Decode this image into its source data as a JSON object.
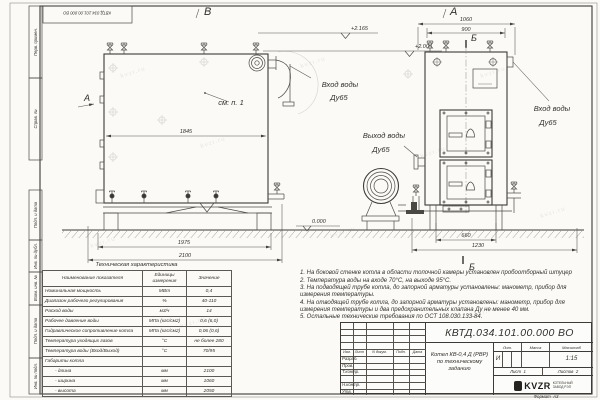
{
  "frame": {
    "doc_number": "КВТД.034.101.00.000 ВО",
    "format_label": "Формат",
    "format_value": "А3",
    "side_labels": [
      "Перв. примен.",
      "Справ. №",
      "Подп. и дата",
      "Инв. № дубл.",
      "Взам. инв. №",
      "Подп. и дата",
      "Инв. № подл."
    ]
  },
  "views": {
    "view_b_label": "В",
    "view_a_label": "А",
    "section_label": "Б",
    "see_note": "см. п. 1",
    "dims": {
      "left_inner": "1845",
      "left_mid": "1975",
      "left_outer": "2100",
      "right_outer": "1060",
      "right_inner": "900",
      "right_base": "660",
      "right_total": "1230"
    },
    "elevations": {
      "top": "+2.165",
      "mid": "+2.000",
      "ground": "0.000"
    },
    "water": {
      "inlet": "Вход воды",
      "outlet": "Выход воды",
      "dy": "Ду65"
    }
  },
  "tech_table": {
    "title": "Техническая характеристика",
    "headers": {
      "name": "Наименование показателя",
      "unit": "Единицы измерения",
      "value": "Значение"
    },
    "rows": [
      {
        "name": "Номинальная мощность",
        "unit": "МВт",
        "value": "0,4"
      },
      {
        "name": "Диапазон рабочего регулирования",
        "unit": "%",
        "value": "40-110"
      },
      {
        "name": "Расход воды",
        "unit": "м3/ч",
        "value": "14"
      },
      {
        "name": "Рабочее давление воды",
        "unit": "МПа (кгс/см2)",
        "value": "0,6 (6,0)"
      },
      {
        "name": "Гидравлическое сопротивление котла",
        "unit": "МПа (кгс/см2)",
        "value": "0,06 (0,6)"
      },
      {
        "name": "Температура уходящих газов",
        "unit": "°С",
        "value": "не более 280"
      },
      {
        "name": "Температура воды (Вход/Выход)",
        "unit": "°С",
        "value": "70/95"
      },
      {
        "name": "Габариты котла",
        "unit": "",
        "value": ""
      },
      {
        "name": "- длина",
        "unit": "мм",
        "value": "2100"
      },
      {
        "name": "- ширина",
        "unit": "мм",
        "value": "1060"
      },
      {
        "name": "- высота",
        "unit": "мм",
        "value": "2050"
      }
    ]
  },
  "notes": {
    "items": [
      "1. На боковой стенке котла в области топочной камеры установлен пробоотборный штуцер",
      "2. Температура воды на входе 70°С, на выходе 95°С.",
      "3. На подводящей трубе котла, до запорной арматуры установлены: манометр, прибор для измерения температуры.",
      "4. На отводящей трубе котла, до запорной арматуры установлены: манометр, прибор для измерения температуры и два предохранительных клапана Ду не менее 40 мм.",
      "5. Остальные технические требования по ОСТ 108.030.133-84."
    ]
  },
  "title_block": {
    "doc_number": "КВТД.034.101.00.000  ВО",
    "product_line1": "Котел  КВ-0,4  Д  (РВР)",
    "product_line2": "по техническому заданию",
    "lit_header": "Лит.",
    "mass_header": "Масса",
    "scale_header": "Масштаб",
    "lit_value": "И",
    "scale_value": "1:15",
    "sheet_label": "Лист",
    "sheet_value": "1",
    "sheets_label": "Листов",
    "sheets_value": "2",
    "rev_headers": {
      "izm": "Изм.",
      "list": "Лист",
      "doc": "N докум.",
      "podp": "Подп.",
      "data": "Дата"
    },
    "rev_rows": [
      "Разраб.",
      "Пров.",
      "Т.контр.",
      "",
      "Н.контр.",
      "Утв."
    ],
    "logo_text": "KVZR",
    "logo_caption1": "КОТЕЛЬНЫЙ",
    "logo_caption2": "ЗАВОД РЭП"
  },
  "watermark": "kvzr.ru"
}
